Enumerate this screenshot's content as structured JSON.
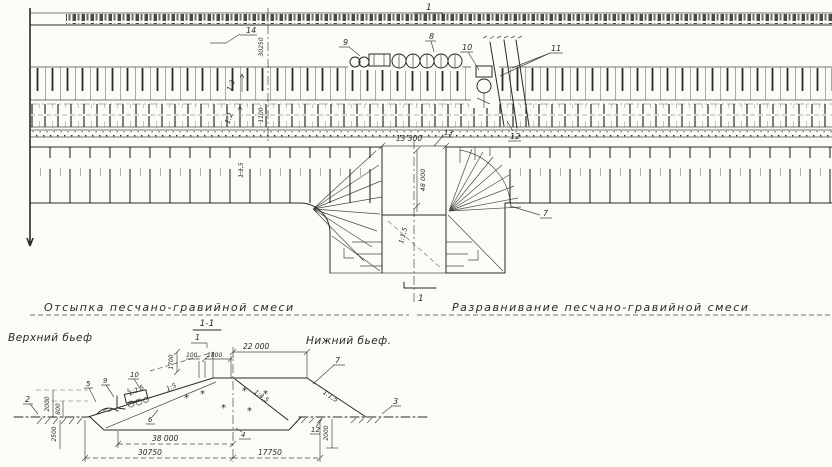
{
  "colors": {
    "ink": "#2b2a25",
    "paper": "#fcfbf7"
  },
  "plan": {
    "marker_top": "1",
    "marker_bottom": "1",
    "zone_left_label": "Отсыпка песчано-гравийной смеси",
    "zone_right_label": "Разравнивание песчано-гравийной смеси",
    "dim_gap_width": "13 300",
    "dim_body_width": "48 000",
    "dim_left_axis": "30250",
    "dim_left_axis_2": "1100",
    "slope_band_a": "1:3",
    "slope_band_b": "1:2",
    "slope_left_inner": "1:1,5",
    "slope_gap": "1:1,5",
    "callouts": {
      "c7": "7",
      "c8": "8",
      "c9": "9",
      "c10": "10",
      "c11": "11",
      "c12": "12",
      "c13": "13",
      "c14": "14"
    }
  },
  "section": {
    "title": "1-1",
    "marker": "1",
    "upstream_label": "Верхний бьеф",
    "downstream_label": "Нижний бьеф.",
    "symbols": {
      "star": "*"
    },
    "dims": {
      "crest_offset": "100",
      "crest_layer": "1800",
      "berm_width": "22 000",
      "core_width": "38 000",
      "upstream_width": "30750",
      "downstream_width": "17750",
      "h_left_upper": "2000",
      "h_left_lower": "800",
      "pit_depth": "2500",
      "h_right": "2000",
      "crest_rise": "1700"
    },
    "slopes": {
      "upstream_flat": "1:5",
      "upstream_steep": "1:2,5",
      "inner": "1:4,5",
      "downstream": "1:1,5"
    },
    "callouts": {
      "c2": "2",
      "c3": "3",
      "c4": "4",
      "c5": "5",
      "c6": "6",
      "c7": "7",
      "c9": "9",
      "c10": "10",
      "c12": "12"
    }
  }
}
